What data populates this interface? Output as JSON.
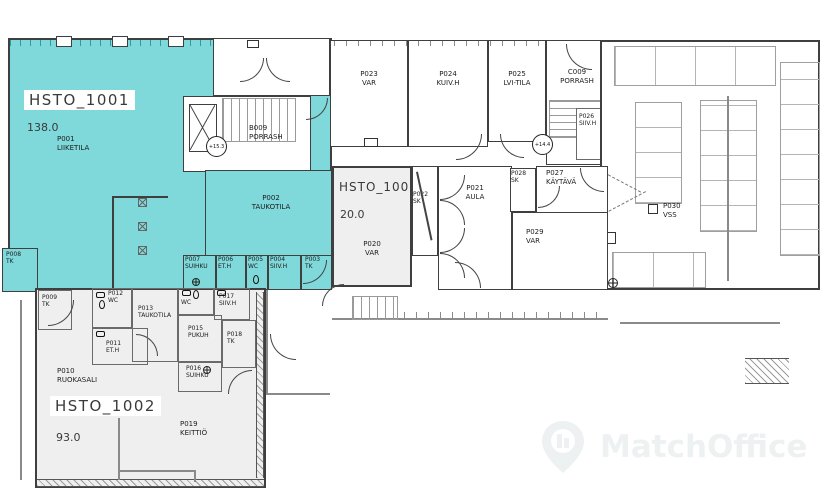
{
  "zones": {
    "hsto1001": {
      "id": "HSTO_1001",
      "area": "138.0"
    },
    "hsto1002": {
      "id": "HSTO_1002",
      "area": "93.0"
    },
    "hsto1003": {
      "id": "HSTO_1003",
      "area": "20.0"
    }
  },
  "rooms": {
    "p001": {
      "num": "P001",
      "name": "LIIKETILA"
    },
    "p002": {
      "num": "P002",
      "name": "TAUKOTILA"
    },
    "p003": {
      "num": "P003",
      "name": "TK"
    },
    "p004": {
      "num": "P004",
      "name": "SIIV.H"
    },
    "p005": {
      "num": "P005",
      "name": "WC"
    },
    "p006": {
      "num": "P006",
      "name": "ET.H"
    },
    "p007": {
      "num": "P007",
      "name": "SUIHKU"
    },
    "p008": {
      "num": "P008",
      "name": "TK"
    },
    "p009": {
      "num": "P009",
      "name": "TK"
    },
    "p010": {
      "num": "P010",
      "name": "RUOKASALI"
    },
    "p011": {
      "num": "P011",
      "name": "ET.H"
    },
    "p012": {
      "num": "P012",
      "name": "WC"
    },
    "p013": {
      "num": "P013",
      "name": "TAUKOTILA"
    },
    "wc": {
      "num": "",
      "name": "WC"
    },
    "p015": {
      "num": "P015",
      "name": "PUKUH"
    },
    "p016": {
      "num": "P016",
      "name": "SUIHKU"
    },
    "p017": {
      "num": "P017",
      "name": "SIIV.H"
    },
    "p018": {
      "num": "P018",
      "name": "TK"
    },
    "p019": {
      "num": "P019",
      "name": "KEITTIÖ"
    },
    "p020": {
      "num": "P020",
      "name": "VAR"
    },
    "p021": {
      "num": "P021",
      "name": "AULA"
    },
    "p022": {
      "num": "P022",
      "name": "SK"
    },
    "p023": {
      "num": "P023",
      "name": "VAR"
    },
    "p024": {
      "num": "P024",
      "name": "KUIV.H"
    },
    "p025": {
      "num": "P025",
      "name": "LVI-TILA"
    },
    "p026": {
      "num": "P026",
      "name": "SIIV.H"
    },
    "p027": {
      "num": "P027",
      "name": "KÄYTÄVÄ"
    },
    "p028": {
      "num": "P028",
      "name": "SK"
    },
    "p029": {
      "num": "P029",
      "name": "VAR"
    },
    "p030": {
      "num": "P030",
      "name": "VSS"
    },
    "b009": {
      "num": "B009",
      "name": "PORRASH"
    },
    "c009": {
      "num": "C009",
      "name": "PORRASH"
    }
  },
  "markers": {
    "level_b": "+15.3",
    "level_c": "+14.4"
  },
  "watermark": {
    "label": "MatchOffice"
  },
  "icons": {
    "watermark_pin": "map-pin",
    "column": "column-cross-square",
    "elevator": "elevator-x",
    "drain": "floor-drain-circle"
  },
  "colors": {
    "highlight_teal": "#7FD8DA",
    "zone_gray": "#EFEFEF",
    "wall": "#3F3F3F",
    "watermark_gray": "#EEF1F1"
  }
}
